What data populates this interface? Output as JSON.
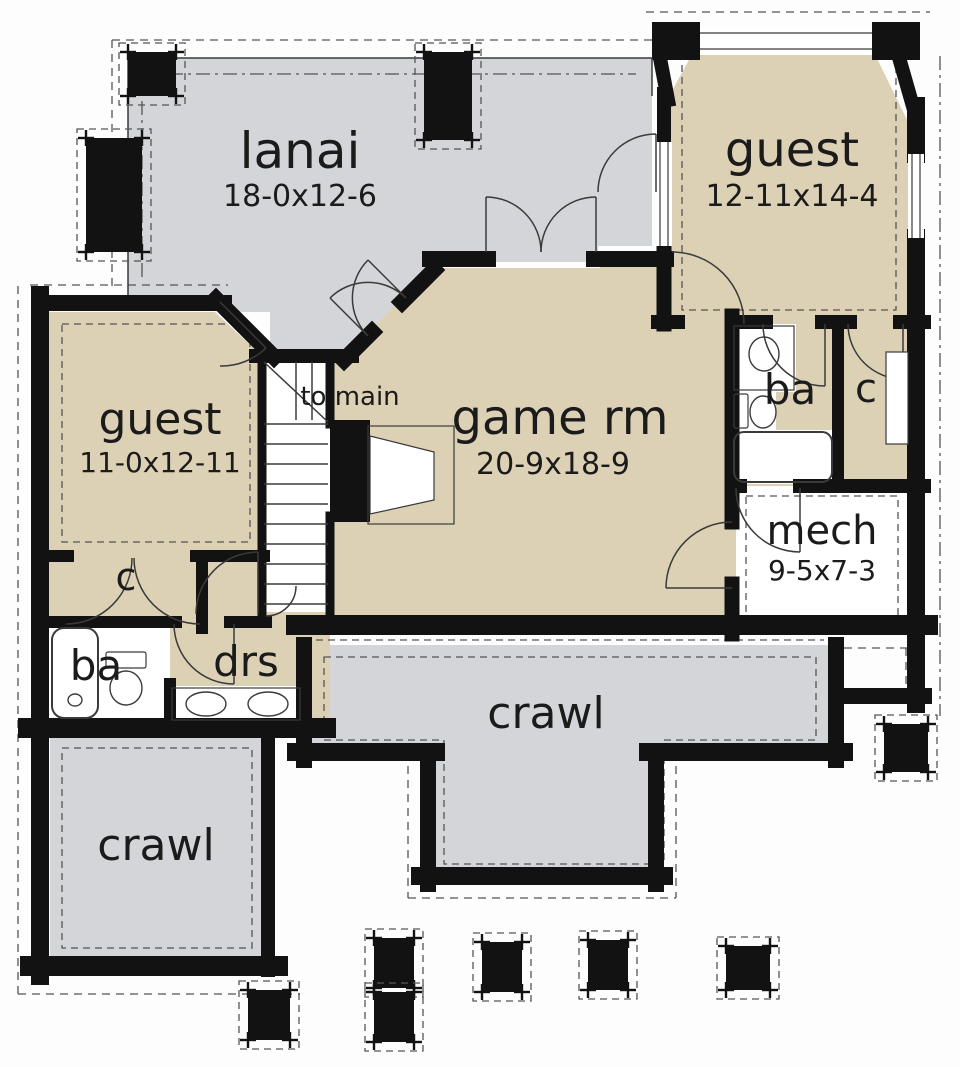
{
  "palette": {
    "tan": "#ddd1b5",
    "gray": "#d3d5d8",
    "wall": "#121212",
    "line": "#3a3a3a",
    "dash": "#555555",
    "white": "#ffffff",
    "text": "#1b1b1b"
  },
  "rooms": [
    {
      "id": "lanai",
      "name": "lanai",
      "dims": "18-0x12-6"
    },
    {
      "id": "guest-upper",
      "name": "guest",
      "dims": "12-11x14-4"
    },
    {
      "id": "guest-lower",
      "name": "guest",
      "dims": "11-0x12-11"
    },
    {
      "id": "game-room",
      "name": "game rm",
      "dims": "20-9x18-9"
    },
    {
      "id": "stair-landing",
      "name": "to main",
      "dims": ""
    },
    {
      "id": "bath-right",
      "name": "ba",
      "dims": ""
    },
    {
      "id": "closet-right",
      "name": "c",
      "dims": ""
    },
    {
      "id": "mech",
      "name": "mech",
      "dims": "9-5x7-3"
    },
    {
      "id": "closet-left",
      "name": "c",
      "dims": ""
    },
    {
      "id": "bath-left",
      "name": "ba",
      "dims": ""
    },
    {
      "id": "dressing",
      "name": "drs",
      "dims": ""
    },
    {
      "id": "crawl-center",
      "name": "crawl",
      "dims": ""
    },
    {
      "id": "crawl-left",
      "name": "crawl",
      "dims": ""
    }
  ],
  "plan": {
    "fills": [
      {
        "name": "lanai-floor",
        "color": "gray",
        "pts": "128,58 652,58 652,246 598,246 598,262 438,262 348,352 270,352 270,312 220,312 220,295 128,295"
      },
      {
        "name": "crawl-center-floor",
        "color": "gray",
        "pts": "312,645 828,645 828,752 660,752 660,872 432,872 432,752 312,752"
      },
      {
        "name": "crawl-left-floor",
        "color": "gray",
        "pts": "50,736 264,736 264,960 50,960"
      },
      {
        "name": "guest-lower-floor",
        "color": "tan",
        "pts": "48,312 215,312 266,360 266,722 48,722"
      },
      {
        "name": "hall-lower-floor",
        "color": "tan",
        "pts": "262,612 330,612 330,722 262,722"
      },
      {
        "name": "game-room-floor",
        "color": "tan",
        "pts": "344,356 432,268 600,268 600,252 672,252 672,322 740,322 740,618 296,618 296,356"
      },
      {
        "name": "guest-upper-floor",
        "color": "tan",
        "pts": "700,40 868,40 908,122 908,486 718,486 718,322 668,322 668,98"
      },
      {
        "name": "stairs-floor",
        "color": "white",
        "pts": "262,358 330,358 330,612 262,612"
      },
      {
        "name": "mech-floor",
        "color": "white",
        "pts": "736,486 908,486 908,630 736,630"
      },
      {
        "name": "bath-right-sink-zone",
        "color": "white",
        "pts": "732,324 796,324 796,392 732,392"
      },
      {
        "name": "bath-right-toilet-zone",
        "color": "white",
        "pts": "732,392 776,392 776,430 732,430"
      },
      {
        "name": "bath-right-tub-zone",
        "color": "white",
        "pts": "732,430 834,430 834,484 732,484"
      },
      {
        "name": "bath-left-fixture-zone",
        "color": "white",
        "pts": "48,624 170,624 170,722 48,722"
      },
      {
        "name": "dressing-vanity-zone",
        "color": "white",
        "pts": "170,686 302,686 302,722 170,722"
      }
    ],
    "blackRects": [
      {
        "name": "bay-corner-left",
        "x": 652,
        "y": 22,
        "w": 48,
        "h": 38
      },
      {
        "name": "bay-corner-right",
        "x": 872,
        "y": 22,
        "w": 48,
        "h": 38
      },
      {
        "name": "fireplace-mass",
        "x": 330,
        "y": 420,
        "w": 40,
        "h": 102
      }
    ],
    "walls": [
      [
        40,
        303,
        224,
        303,
        16
      ],
      [
        216,
        299,
        274,
        357,
        16
      ],
      [
        40,
        295,
        40,
        738,
        18
      ],
      [
        40,
        726,
        40,
        976,
        18
      ],
      [
        30,
        966,
        278,
        966,
        20
      ],
      [
        268,
        734,
        268,
        970,
        14
      ],
      [
        28,
        728,
        326,
        728,
        20
      ],
      [
        48,
        556,
        68,
        556,
        12
      ],
      [
        196,
        556,
        264,
        556,
        12
      ],
      [
        202,
        556,
        202,
        628,
        12
      ],
      [
        48,
        622,
        176,
        622,
        12
      ],
      [
        230,
        622,
        266,
        622,
        12
      ],
      [
        170,
        684,
        170,
        726,
        12
      ],
      [
        262,
        350,
        262,
        618,
        9
      ],
      [
        256,
        356,
        352,
        356,
        14
      ],
      [
        330,
        356,
        330,
        424,
        9
      ],
      [
        330,
        516,
        330,
        616,
        9
      ],
      [
        344,
        360,
        372,
        332,
        16
      ],
      [
        402,
        302,
        434,
        270,
        16
      ],
      [
        430,
        259,
        488,
        259,
        16
      ],
      [
        594,
        259,
        666,
        259,
        16
      ],
      [
        664,
        252,
        664,
        324,
        15
      ],
      [
        660,
        58,
        668,
        100,
        14
      ],
      [
        898,
        54,
        914,
        110,
        14
      ],
      [
        664,
        94,
        664,
        142,
        14
      ],
      [
        916,
        106,
        916,
        154,
        18
      ],
      [
        916,
        238,
        916,
        631,
        18
      ],
      [
        916,
        627,
        916,
        704,
        18
      ],
      [
        840,
        696,
        924,
        696,
        16
      ],
      [
        658,
        322,
        678,
        322,
        14
      ],
      [
        744,
        322,
        766,
        322,
        14
      ],
      [
        822,
        322,
        850,
        322,
        14
      ],
      [
        900,
        322,
        924,
        322,
        14
      ],
      [
        838,
        322,
        838,
        486,
        12
      ],
      [
        732,
        486,
        740,
        486,
        14
      ],
      [
        800,
        486,
        924,
        486,
        14
      ],
      [
        732,
        316,
        732,
        522,
        15
      ],
      [
        732,
        584,
        732,
        634,
        15
      ],
      [
        296,
        625,
        928,
        625,
        20
      ],
      [
        304,
        645,
        304,
        760,
        16
      ],
      [
        296,
        752,
        436,
        752,
        18
      ],
      [
        428,
        752,
        428,
        884,
        16
      ],
      [
        420,
        876,
        664,
        876,
        18
      ],
      [
        656,
        752,
        656,
        884,
        16
      ],
      [
        648,
        752,
        844,
        752,
        18
      ],
      [
        836,
        645,
        836,
        760,
        16
      ]
    ],
    "thin": [
      [
        128,
        58,
        652,
        58
      ],
      [
        128,
        58,
        128,
        295
      ],
      [
        652,
        58,
        652,
        96
      ],
      [
        296,
        362,
        296,
        420
      ],
      [
        312,
        362,
        312,
        420
      ],
      [
        264,
        362,
        328,
        422
      ],
      [
        368,
        336,
        330,
        298
      ],
      [
        406,
        298,
        368,
        260
      ],
      [
        486,
        252,
        486,
        197
      ],
      [
        596,
        252,
        596,
        197
      ],
      [
        825,
        324,
        825,
        386
      ],
      [
        903,
        324,
        903,
        379
      ],
      [
        800,
        488,
        800,
        552
      ],
      [
        732,
        588,
        666,
        588
      ],
      [
        220,
        302,
        266,
        348
      ],
      [
        258,
        614,
        258,
        552
      ],
      [
        234,
        624,
        234,
        684
      ],
      [
        656,
        192,
        656,
        134
      ]
    ],
    "stairs": {
      "x1": 264,
      "x2": 328,
      "yStart": 424,
      "yEnd": 604,
      "step": 20
    },
    "doors": [
      {
        "d": "M406,298 A54,54 0 0 0 330,298"
      },
      {
        "d": "M368,336 A54,54 0 0 1 368,260"
      },
      {
        "d": "M541,252 A55,55 0 0 0 486,197"
      },
      {
        "d": "M541,252 A55,55 0 0 1 596,197"
      },
      {
        "d": "M744,324 A72,72 0 0 0 672,252"
      },
      {
        "d": "M763,324 A62,62 0 0 0 825,386"
      },
      {
        "d": "M848,324 A55,55 0 0 0 903,379"
      },
      {
        "d": "M736,488 A64,64 0 0 0 800,552"
      },
      {
        "d": "M666,588 A66,66 0 0 1 732,522"
      },
      {
        "d": "M266,348 A64,64 0 0 1 220,366"
      },
      {
        "d": "M132,558 A66,66 0 0 1 66,624"
      },
      {
        "d": "M134,558 A66,66 0 0 0 200,624"
      },
      {
        "d": "M258,552 A62,62 0 0 0 196,614"
      },
      {
        "d": "M174,624 A60,60 0 0 0 234,684"
      },
      {
        "d": "M656,134 A58,58 0 0 0 598,192"
      },
      {
        "d": "M266,616 A30,30 0 0 0 296,586"
      }
    ],
    "windows": [
      {
        "x": 700,
        "y": 27,
        "w": 172,
        "h": 28,
        "horiz": true
      },
      {
        "x": 656,
        "y": 142,
        "w": 16,
        "h": 104,
        "horiz": false
      },
      {
        "x": 908,
        "y": 154,
        "w": 16,
        "h": 84,
        "horiz": false
      }
    ],
    "dashed": [
      {
        "d": "M112,40 H656",
        "dash": "8 6"
      },
      {
        "d": "M112,40 V292",
        "dash": "8 6"
      },
      {
        "d": "M18,286 V994",
        "dash": "8 6"
      },
      {
        "d": "M18,994 H300",
        "dash": "8 6"
      },
      {
        "d": "M646,12 H930",
        "dash": "8 6"
      },
      {
        "d": "M940,56 V716",
        "dash": "14 5 3 5"
      },
      {
        "d": "M408,752 V898 M408,898 H676 M676,752 V898",
        "dash": "8 6"
      },
      {
        "d": "M844,648 H910 M906,648 V690",
        "dash": "8 6"
      },
      {
        "d": "M142,74 H636",
        "dash": "14 5 3 5"
      },
      {
        "d": "M142,74 V282",
        "dash": "14 5 3 5"
      },
      {
        "d": "M62,324 H250 V542 H62 Z",
        "dash": "7 5"
      },
      {
        "d": "M682,52 H896 V310 H682 Z",
        "dash": "7 5"
      },
      {
        "d": "M746,496 H898 V618 H746 Z",
        "dash": "7 5"
      },
      {
        "d": "M324,657 H816 V740 H664 V864 H444 V740 H324 Z",
        "dash": "7 5"
      },
      {
        "d": "M62,748 H252 V948 H62 Z",
        "dash": "7 5"
      },
      {
        "d": "M304,640 H824",
        "dash": "7 5"
      },
      {
        "d": "M30,285 H228",
        "dash": "8 6"
      },
      {
        "d": "M420,452 V500",
        "dash": "6 5"
      }
    ],
    "fireplace": {
      "thinRect": {
        "x": 368,
        "y": 426,
        "w": 86,
        "h": 98
      },
      "whitePoly": "370,436 434,452 434,500 370,514"
    },
    "fixtureRects": [
      {
        "name": "tub-right",
        "x": 734,
        "y": 432,
        "w": 98,
        "h": 50,
        "rx": 10,
        "sw": 2
      },
      {
        "name": "tub-left",
        "x": 52,
        "y": 628,
        "w": 46,
        "h": 90,
        "rx": 12,
        "sw": 2
      },
      {
        "name": "sink-counter-right",
        "x": 734,
        "y": 326,
        "w": 60,
        "h": 64,
        "rx": 0,
        "sw": 1.2
      },
      {
        "name": "toilet-tank-right",
        "x": 734,
        "y": 394,
        "w": 14,
        "h": 34,
        "rx": 2,
        "sw": 1.2
      },
      {
        "name": "toilet-tank-left",
        "x": 106,
        "y": 652,
        "w": 40,
        "h": 16,
        "rx": 2,
        "sw": 1.2
      },
      {
        "name": "vanity-counter",
        "x": 172,
        "y": 688,
        "w": 128,
        "h": 32,
        "rx": 0,
        "sw": 1.2
      },
      {
        "name": "closet-shelf-right",
        "x": 886,
        "y": 352,
        "w": 22,
        "h": 92,
        "rx": 0,
        "sw": 1.2,
        "fill": "#ffffff"
      }
    ],
    "fixtureEllipses": [
      {
        "name": "sink-bowl-right",
        "cx": 764,
        "cy": 354,
        "rx": 15,
        "ry": 17
      },
      {
        "name": "toilet-bowl-right",
        "cx": 763,
        "cy": 412,
        "rx": 13,
        "ry": 16
      },
      {
        "name": "toilet-bowl-left",
        "cx": 126,
        "cy": 688,
        "rx": 16,
        "ry": 17
      },
      {
        "name": "vanity-sink-1",
        "cx": 206,
        "cy": 704,
        "rx": 20,
        "ry": 12
      },
      {
        "name": "vanity-sink-2",
        "cx": 268,
        "cy": 704,
        "rx": 20,
        "ry": 12
      },
      {
        "name": "tub-drain-left",
        "cx": 75,
        "cy": 700,
        "rx": 7,
        "ry": 6
      }
    ],
    "posts": [
      {
        "x": 128,
        "y": 52,
        "w": 48,
        "h": 44
      },
      {
        "x": 86,
        "y": 138,
        "w": 56,
        "h": 114
      },
      {
        "x": 424,
        "y": 52,
        "w": 48,
        "h": 88
      },
      {
        "x": 884,
        "y": 724,
        "w": 44,
        "h": 48
      },
      {
        "x": 248,
        "y": 990,
        "w": 42,
        "h": 50
      },
      {
        "x": 374,
        "y": 938,
        "w": 40,
        "h": 50
      },
      {
        "x": 374,
        "y": 992,
        "w": 40,
        "h": 50
      },
      {
        "x": 482,
        "y": 942,
        "w": 40,
        "h": 50
      },
      {
        "x": 588,
        "y": 940,
        "w": 40,
        "h": 50
      },
      {
        "x": 726,
        "y": 946,
        "w": 44,
        "h": 44
      }
    ]
  }
}
